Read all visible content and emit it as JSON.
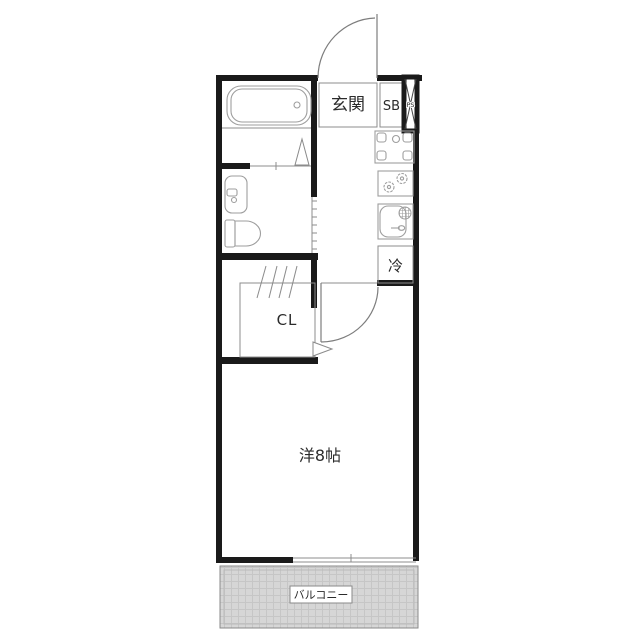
{
  "floor_plan": {
    "kind": "japanese-apartment-floor-plan",
    "labels": {
      "genkan": "玄関",
      "shoe_box": "SB",
      "pipe_space": "PS",
      "fridge": "冷",
      "closet": "CL",
      "main_room": "洋8帖",
      "balcony": "バルコニー"
    },
    "colors": {
      "wall": "#1a1a1a",
      "line": "#8c8c8c",
      "fixture": "#9e9e9e",
      "text": "#2b2b2b",
      "balcony_fill": "#d6d6d6",
      "balcony_grid": "#c6c6c6",
      "background": "#ffffff"
    }
  }
}
